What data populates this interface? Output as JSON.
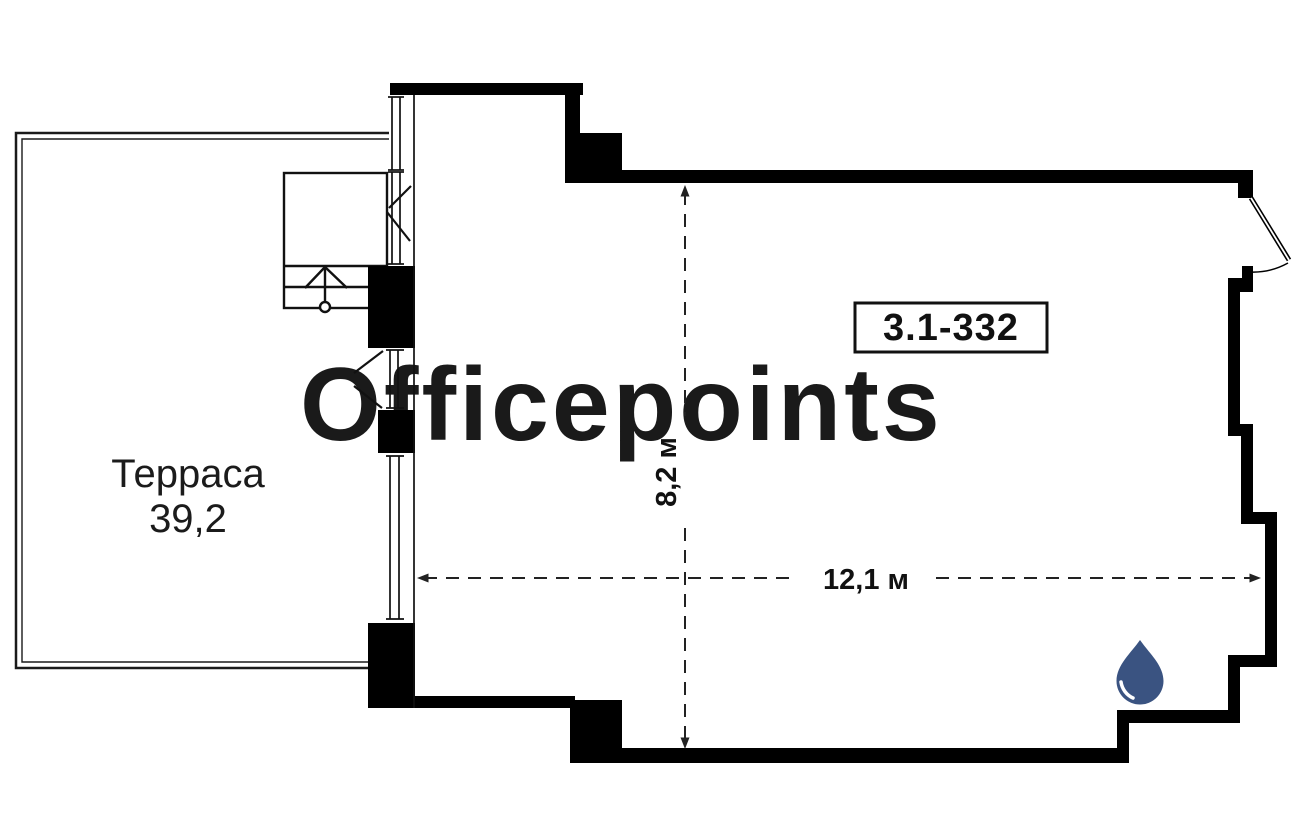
{
  "plan": {
    "watermark": "Officepoints",
    "room": {
      "number": "3.1-332"
    },
    "terrace": {
      "label": "Терраса",
      "area": "39,2"
    },
    "dimensions": {
      "horizontal": "12,1 м",
      "vertical": "8,2 м"
    },
    "colors": {
      "wall": "#000000",
      "watermark": "#f1f1f1",
      "drop": "#3a5381"
    }
  }
}
